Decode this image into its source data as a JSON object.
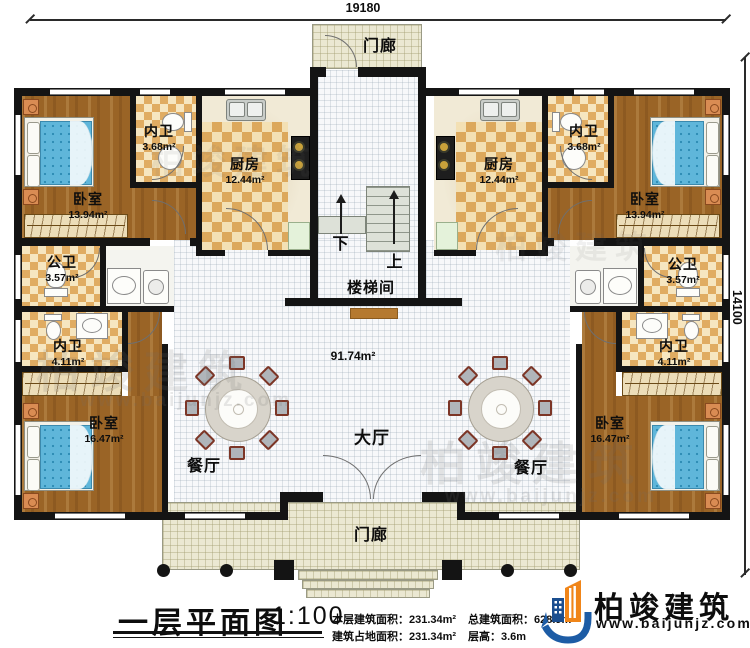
{
  "dimensions": {
    "width_top": "19180",
    "height_right": "14100"
  },
  "rooms": {
    "porch_top": {
      "name": "门廊"
    },
    "porch_bottom": {
      "name": "门廊"
    },
    "stairwell": {
      "name": "楼梯间"
    },
    "stairs_down": "下",
    "stairs_up": "上",
    "hall": {
      "name": "大厅",
      "area": "91.74m²"
    },
    "dining_left": {
      "name": "餐厅"
    },
    "dining_right": {
      "name": "餐厅"
    },
    "kitchen_left": {
      "name": "厨房",
      "area": "12.44m²"
    },
    "kitchen_right": {
      "name": "厨房",
      "area": "12.44m²"
    },
    "bath_inner_top_left": {
      "name": "内卫",
      "area": "3.68m²"
    },
    "bath_inner_top_right": {
      "name": "内卫",
      "area": "3.68m²"
    },
    "bath_inner_bottom_left": {
      "name": "内卫",
      "area": "4.11m²"
    },
    "bath_inner_bottom_right": {
      "name": "内卫",
      "area": "4.11m²"
    },
    "bath_public_left": {
      "name": "公卫",
      "area": "3.57m²"
    },
    "bath_public_right": {
      "name": "公卫",
      "area": "3.57m²"
    },
    "bedroom_top_left": {
      "name": "卧室",
      "area": "13.94m²"
    },
    "bedroom_top_right": {
      "name": "卧室",
      "area": "13.94m²"
    },
    "bedroom_bottom_left": {
      "name": "卧室",
      "area": "16.47m²"
    },
    "bedroom_bottom_right": {
      "name": "卧室",
      "area": "16.47m²"
    }
  },
  "title_block": {
    "title": "一层平面图",
    "scale": "1:100",
    "stats": [
      {
        "label": "本层建筑面积：",
        "value": "231.34m²"
      },
      {
        "label": "总建筑面积：",
        "value": "628.9m²"
      },
      {
        "label": "建筑占地面积：",
        "value": "231.34m²"
      },
      {
        "label": "层高：",
        "value": "3.6m"
      }
    ]
  },
  "logo": {
    "brand": "柏竣建筑",
    "url": "www.baijunjz.com"
  },
  "watermark": {
    "brand": "柏竣建筑",
    "url": "www.baijunjz.com"
  },
  "colors": {
    "logo_blue": "#1d5ca5",
    "logo_orange": "#f08519",
    "wall": "#141414",
    "wood": "#9a6426",
    "checker_dark": "#dca85c",
    "checker_light": "#f3e0b4"
  }
}
